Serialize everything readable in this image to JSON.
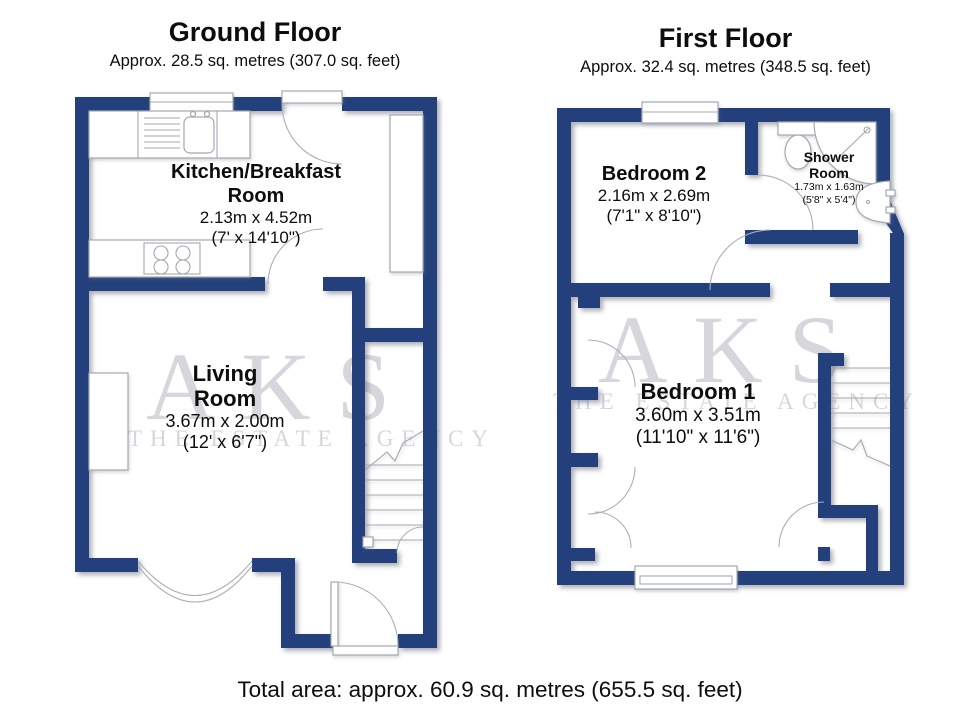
{
  "colors": {
    "wall": "#23407d",
    "watermark": "#d6d6dc",
    "fixture_line": "#a4a8b0",
    "text": "#0d0d0d"
  },
  "watermark": {
    "line1": "AKS",
    "line2": "THE ESTATE AGENCY"
  },
  "floors": [
    {
      "title": "Ground Floor",
      "subtitle": "Approx. 28.5 sq. metres (307.0 sq. feet)",
      "rooms": [
        {
          "line1": "Kitchen/Breakfast",
          "line2": "Room",
          "metric": "2.13m x 4.52m",
          "imperial": "(7' x 14'10\")"
        },
        {
          "line1": "Living",
          "line2": "Room",
          "metric": "3.67m x 2.00m",
          "imperial": "(12' x 6'7\")"
        }
      ]
    },
    {
      "title": "First Floor",
      "subtitle": "Approx. 32.4 sq. metres (348.5 sq. feet)",
      "rooms": [
        {
          "line1": "Bedroom 2",
          "metric": "2.16m x 2.69m",
          "imperial": "(7'1\" x 8'10\")"
        },
        {
          "line1": "Shower",
          "line2": "Room",
          "metric": "1.73m x 1.63m",
          "imperial": "(5'8\" x 5'4\")"
        },
        {
          "line1": "Bedroom 1",
          "metric": "3.60m x 3.51m",
          "imperial": "(11'10\" x 11'6\")"
        }
      ]
    }
  ],
  "footer": {
    "total_area": "Total area: approx. 60.9 sq. metres (655.5 sq. feet)"
  }
}
